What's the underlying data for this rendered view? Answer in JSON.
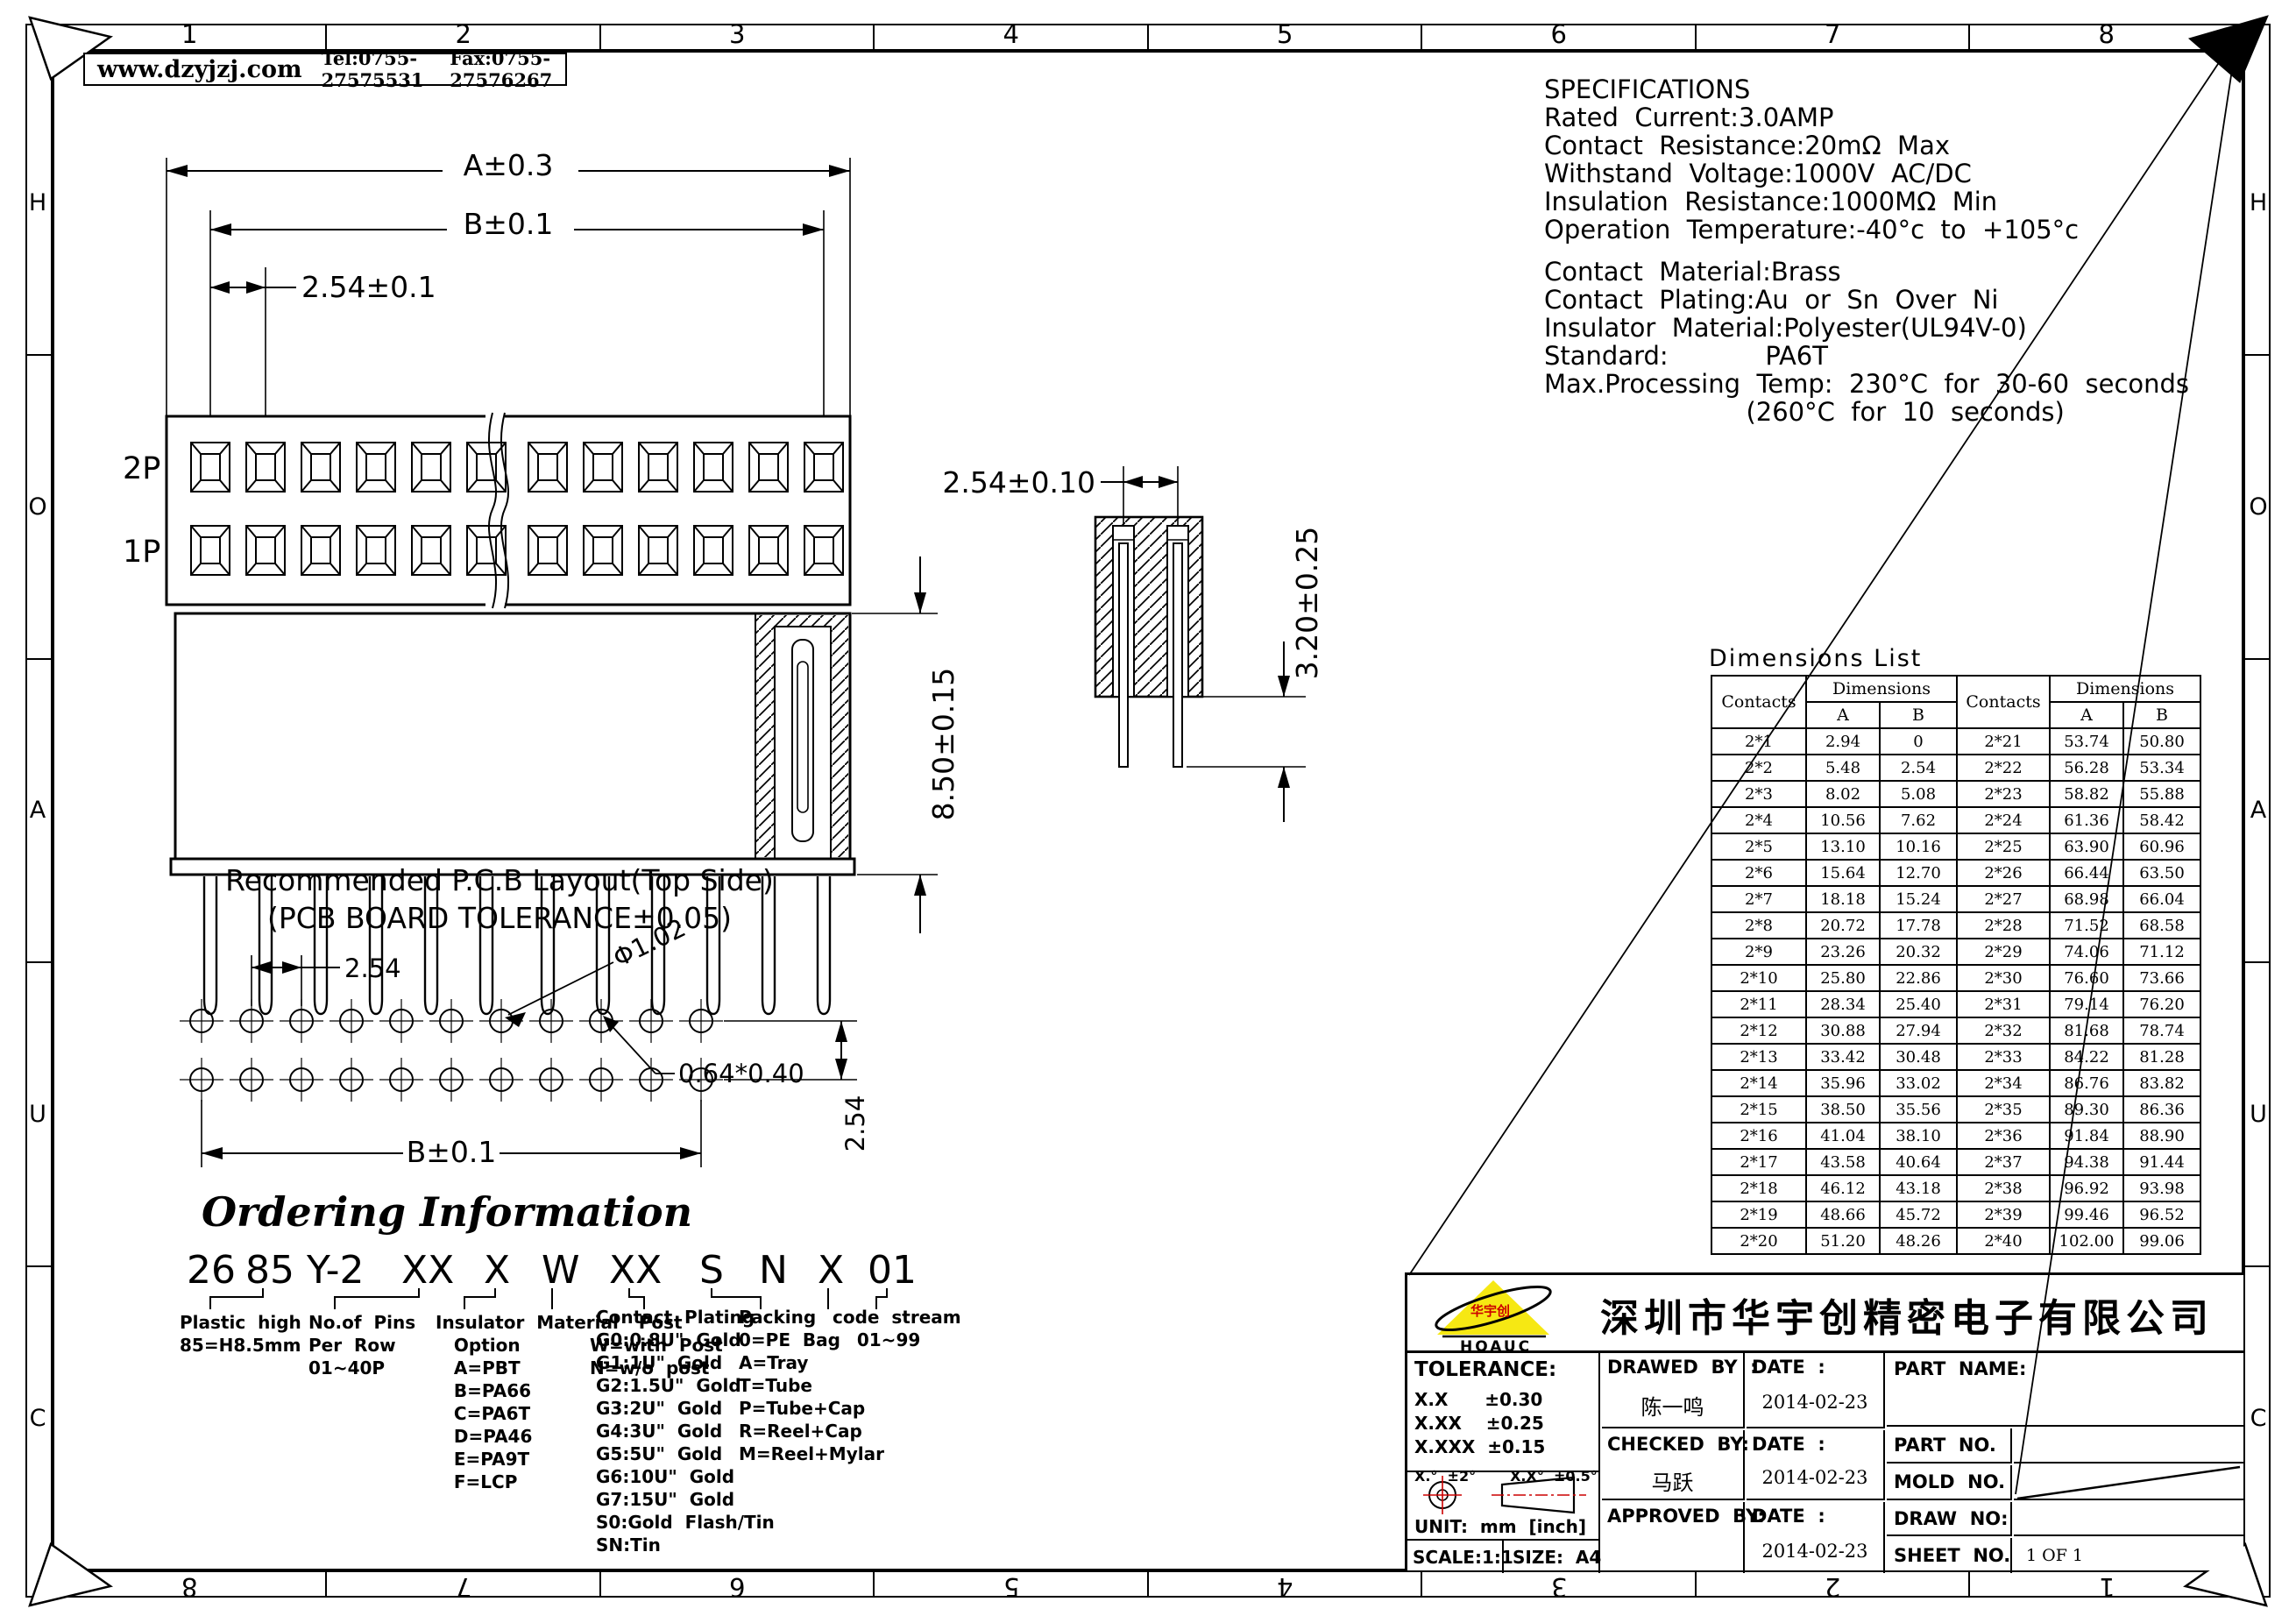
{
  "frame": {
    "top_numbers": [
      "1",
      "2",
      "3",
      "4",
      "5",
      "6",
      "7",
      "8"
    ],
    "bottom_numbers": [
      "8",
      "7",
      "6",
      "5",
      "4",
      "3",
      "2",
      "1"
    ],
    "side_letters": [
      "H",
      "O",
      "A",
      "U",
      "C"
    ]
  },
  "header": {
    "website": "www.dzyjzj.com",
    "tel": "Tel:0755-27575531",
    "fax": "Fax:0755-27576267"
  },
  "specifications": {
    "lines": [
      "SPECIFICATIONS",
      "Rated  Current:3.0AMP",
      "Contact  Resistance:20mΩ  Max",
      "Withstand  Voltage:1000V  AC/DC",
      "Insulation  Resistance:1000MΩ  Min",
      "Operation  Temperature:-40°c  to  +105°c",
      "",
      "Contact  Material:Brass",
      "Contact  Plating:Au  or  Sn  Over  Ni",
      "Insulator  Material:Polyester(UL94V-0)",
      "Standard:            PA6T",
      "Max.Processing  Temp:  230°C  for  30-60  seconds",
      "                         (260°C  for  10  seconds)"
    ]
  },
  "top_view": {
    "dim_a": "A±0.3",
    "dim_b": "B±0.1",
    "dim_pitch": "2.54±0.1",
    "row2_label": "2P",
    "row1_label": "1P"
  },
  "front_view": {
    "dim_height": "8.50±0.15",
    "pin_note": "0.64*0.40"
  },
  "section_view": {
    "dim_pitch": "2.54±0.10",
    "dim_tail": "3.20±0.25"
  },
  "pcb_layout": {
    "title": "Recommended  P.C.B  Layout(Top  Side)",
    "subtitle": "(PCB  BOARD  TOLERANCE±0.05)",
    "dim_pitch": "2.54",
    "dim_hole": "Φ1.02",
    "dim_span": "B±0.1",
    "dim_row": "2.54"
  },
  "ordering": {
    "title": "Ordering Information",
    "code_segments": [
      "26",
      "85",
      "Y-2",
      "XX",
      "X",
      "W",
      "XX",
      "S",
      "N",
      "X",
      "01"
    ],
    "columns": [
      {
        "lines": [
          "Plastic  high",
          "85=H8.5mm"
        ]
      },
      {
        "lines": [
          "No.of  Pins",
          "Per  Row",
          "01~40P"
        ]
      },
      {
        "lines": [
          "Insulator  Material",
          "   Option",
          "   A=PBT",
          "   B=PA66",
          "   C=PA6T",
          "   D=PA46",
          "   E=PA9T",
          "   F=LCP"
        ]
      },
      {
        "lines": [
          "        Post",
          "W=with  Post",
          "N=w/o  post"
        ]
      },
      {
        "lines": [
          "Contact  Plating",
          "G0:0.8U\"  Gold",
          "G1:1U\"  Gold",
          "G2:1.5U\"  Gold",
          "G3:2U\"  Gold",
          "G4:3U\"  Gold",
          "G5:5U\"  Gold",
          "G6:10U\"  Gold",
          "G7:15U\"  Gold",
          "S0:Gold  Flash/Tin",
          "SN:Tin"
        ]
      },
      {
        "lines": [
          "Packing",
          "0=PE  Bag",
          "A=Tray",
          "T=Tube",
          "P=Tube+Cap",
          "R=Reel+Cap",
          "M=Reel+Mylar"
        ]
      },
      {
        "lines": [
          "code  stream",
          "    01~99"
        ]
      }
    ]
  },
  "dimensions_list": {
    "title": "Dimensions  List",
    "col_contacts": "Contacts",
    "col_dimensions": "Dimensions",
    "col_a": "A",
    "col_b": "B",
    "rows": [
      [
        "2*1",
        "2.94",
        "0",
        "2*21",
        "53.74",
        "50.80"
      ],
      [
        "2*2",
        "5.48",
        "2.54",
        "2*22",
        "56.28",
        "53.34"
      ],
      [
        "2*3",
        "8.02",
        "5.08",
        "2*23",
        "58.82",
        "55.88"
      ],
      [
        "2*4",
        "10.56",
        "7.62",
        "2*24",
        "61.36",
        "58.42"
      ],
      [
        "2*5",
        "13.10",
        "10.16",
        "2*25",
        "63.90",
        "60.96"
      ],
      [
        "2*6",
        "15.64",
        "12.70",
        "2*26",
        "66.44",
        "63.50"
      ],
      [
        "2*7",
        "18.18",
        "15.24",
        "2*27",
        "68.98",
        "66.04"
      ],
      [
        "2*8",
        "20.72",
        "17.78",
        "2*28",
        "71.52",
        "68.58"
      ],
      [
        "2*9",
        "23.26",
        "20.32",
        "2*29",
        "74.06",
        "71.12"
      ],
      [
        "2*10",
        "25.80",
        "22.86",
        "2*30",
        "76.60",
        "73.66"
      ],
      [
        "2*11",
        "28.34",
        "25.40",
        "2*31",
        "79.14",
        "76.20"
      ],
      [
        "2*12",
        "30.88",
        "27.94",
        "2*32",
        "81.68",
        "78.74"
      ],
      [
        "2*13",
        "33.42",
        "30.48",
        "2*33",
        "84.22",
        "81.28"
      ],
      [
        "2*14",
        "35.96",
        "33.02",
        "2*34",
        "86.76",
        "83.82"
      ],
      [
        "2*15",
        "38.50",
        "35.56",
        "2*35",
        "89.30",
        "86.36"
      ],
      [
        "2*16",
        "41.04",
        "38.10",
        "2*36",
        "91.84",
        "88.90"
      ],
      [
        "2*17",
        "43.58",
        "40.64",
        "2*37",
        "94.38",
        "91.44"
      ],
      [
        "2*18",
        "46.12",
        "43.18",
        "2*38",
        "96.92",
        "93.98"
      ],
      [
        "2*19",
        "48.66",
        "45.72",
        "2*39",
        "99.46",
        "96.52"
      ],
      [
        "2*20",
        "51.20",
        "48.26",
        "2*40",
        "102.00",
        "99.06"
      ]
    ]
  },
  "title_block": {
    "company": "深圳市华宇创精密电子有限公司",
    "logo_text": "HOAUC",
    "logo_cn": "华宇创",
    "tolerance_title": "TOLERANCE:",
    "tolerance_rows": [
      "X.X      ±0.30",
      "X.XX    ±0.25",
      "X.XXX  ±0.15"
    ],
    "tolerance_angles": "X.°  ±2°       X.X°  ±0.5°",
    "unit": "UNIT:  mm  [inch]",
    "scale": "SCALE:1:1",
    "size": "SIZE:  A4",
    "drawed_by_label": "DRAWED  BY  :",
    "drawed_by": "陈一鸣",
    "checked_by_label": "CHECKED  BY:",
    "checked_by": "马跃",
    "approved_by_label": "APPROVED  BY:",
    "date_label": "DATE  :",
    "dates": [
      "2014-02-23",
      "2014-02-23",
      "2014-02-23"
    ],
    "part_name_label": "PART  NAME:",
    "part_no_label": "PART  NO.",
    "mold_no_label": "MOLD  NO.",
    "draw_no_label": "DRAW  NO:",
    "sheet_no_label": "SHEET  NO.",
    "sheet_no": "1 OF 1",
    "accent_red": "#cc0000",
    "logo_yellow": "#f6e813"
  }
}
